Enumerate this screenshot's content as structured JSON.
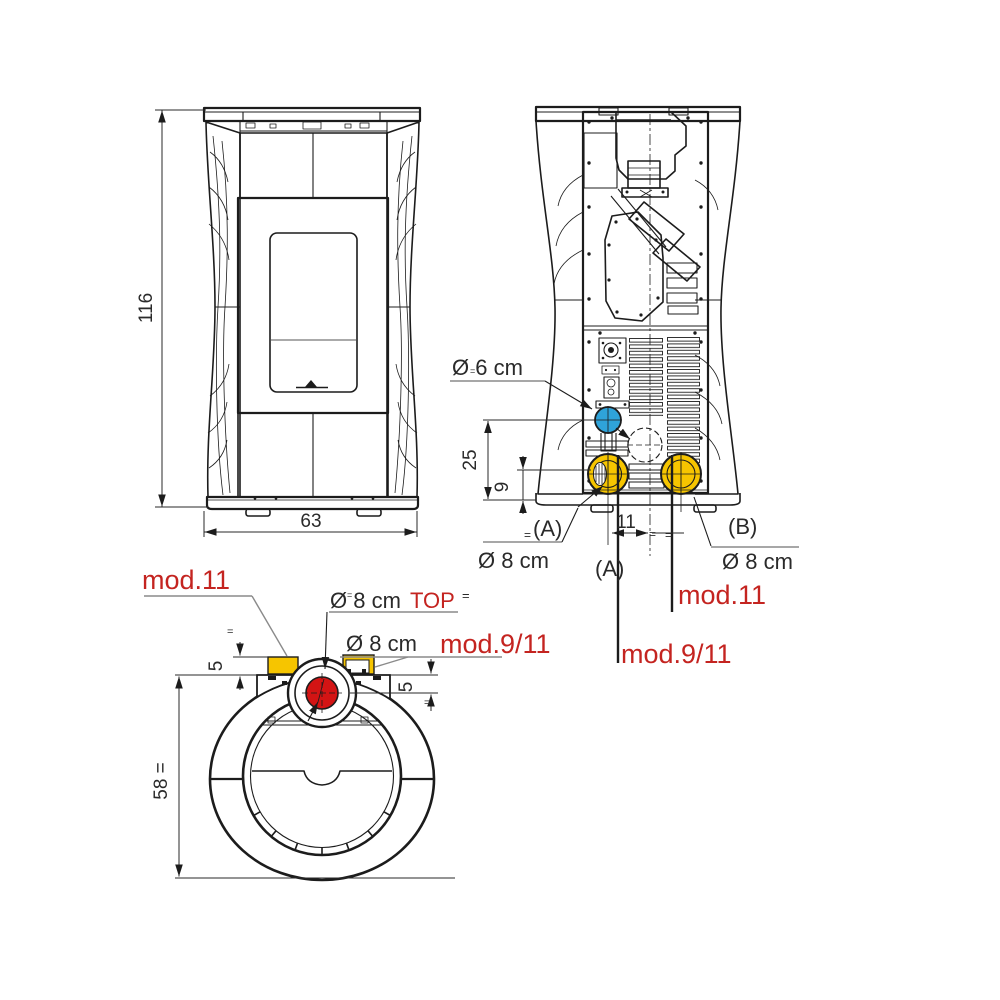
{
  "drawing": {
    "description": "Pellet stove dimensional drawing: front view, rear view, top view",
    "colors": {
      "line": "#1c1c1c",
      "red_label_text": "#c42420",
      "top_flue_red": "#d31414",
      "air_intake_blue": "#2fa3d9",
      "smoke_outlet_yellow": "#f6c500",
      "leader_gray": "#8a8a8a"
    },
    "front_view": {
      "height_cm": "116",
      "width_cm": "63"
    },
    "rear_view": {
      "air_intake_diameter": "Ø 6 cm",
      "intake_height_cm": "25",
      "flue_height_cm": "9",
      "flue_offset_cm": "11",
      "equal_mark": "=",
      "outlet_a_tag": "(A)",
      "outlet_a_diameter": "Ø 8 cm",
      "outlet_a_tag_below": "(A)",
      "outlet_b_tag": "(B)",
      "outlet_b_diameter": "Ø 8 cm",
      "model_11": "mod.11",
      "model_9_11": "mod.9/11"
    },
    "top_view": {
      "model_11": "mod.11",
      "top_flue_diameter": "Ø 8 cm",
      "top_flue_tag": "TOP",
      "rear_flue_diameter": "Ø 8 cm",
      "model_9_11": "mod.9/11",
      "offset_left_cm": "5",
      "offset_right_cm": "5",
      "depth_cm": "58 =",
      "equal_mark": "="
    }
  }
}
